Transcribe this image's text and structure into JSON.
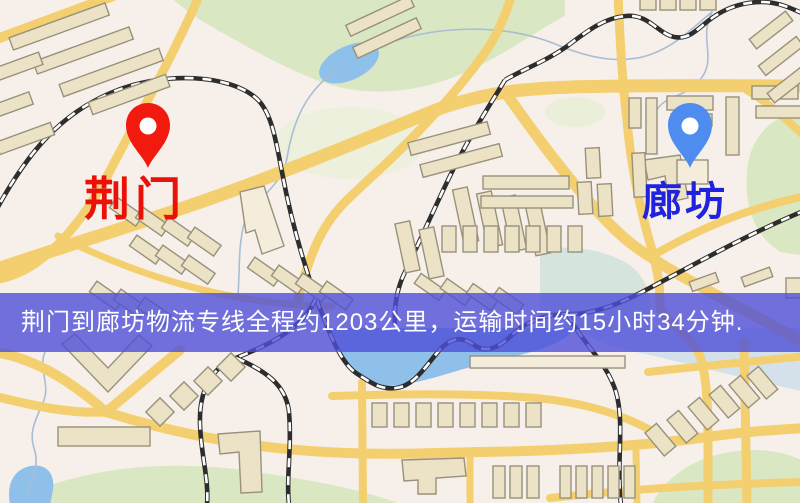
{
  "map": {
    "origin": {
      "name": "荆门"
    },
    "destination": {
      "name": "廊坊"
    },
    "banner": {
      "text": "荆门到廊坊物流专线全程约1203公里，运输时间约15小时34分钟."
    }
  },
  "icons": {
    "origin_pin": "red-map-pin",
    "destination_pin": "blue-map-pin"
  },
  "colors": {
    "map_bg": "#f7f0ea",
    "road": "#f4cf70",
    "park": "#d9e8c2",
    "park_light": "#e7efd6",
    "water": "#8fc0ea",
    "teal_wash": "#c9e0d8",
    "building": "#ece3c7",
    "building_light": "#f4eddc",
    "building_stroke": "#98917b",
    "rail": "#2d2d2d",
    "rail_dash": "#ffffff",
    "stream": "#a9bdd4",
    "pin_origin": "#f2190f",
    "pin_destination": "#4e8cf0",
    "label_origin": "#ea1208",
    "label_destination": "#2023dd",
    "banner_bg": "#4d4fd8",
    "banner_text": "#ffffff"
  }
}
